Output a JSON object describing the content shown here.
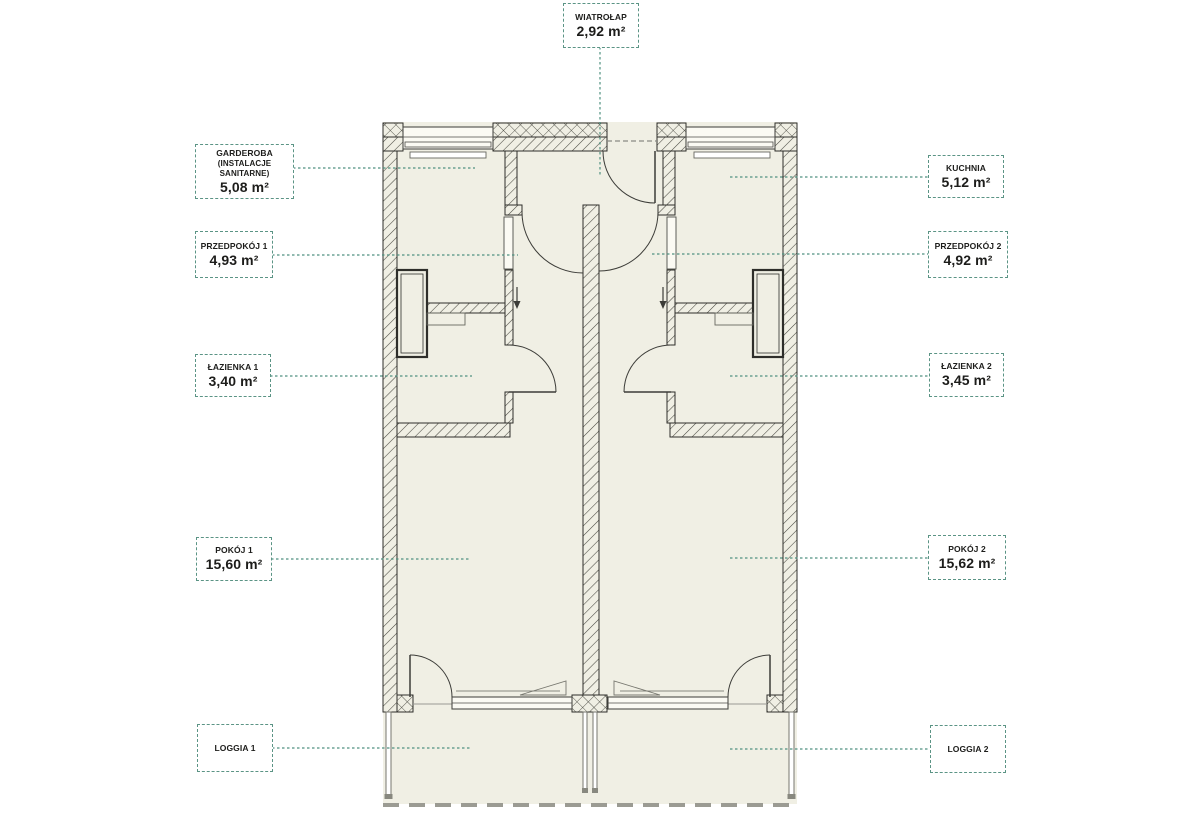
{
  "colors": {
    "accent_teal": "#4f9180",
    "floor_beige": "#f0efe4",
    "wall_line": "#2e2e2a",
    "label_border": "#5b9485"
  },
  "labels": {
    "wiatrolap": {
      "name": "WIATROŁAP",
      "area": "2,92 m²"
    },
    "garderoba": {
      "name": "GARDEROBA",
      "name2": "(INSTALACJE SANITARNE)",
      "area": "5,08 m²"
    },
    "przedpokoj1": {
      "name": "PRZEDPOKÓJ 1",
      "area": "4,93 m²"
    },
    "lazienka1": {
      "name": "ŁAZIENKA 1",
      "area": "3,40 m²"
    },
    "pokoj1": {
      "name": "POKÓJ 1",
      "area": "15,60 m²"
    },
    "loggia1": {
      "name": "LOGGIA 1"
    },
    "kuchnia": {
      "name": "KUCHNIA",
      "area": "5,12 m²"
    },
    "przedpokoj2": {
      "name": "PRZEDPOKÓJ 2",
      "area": "4,92 m²"
    },
    "lazienka2": {
      "name": "ŁAZIENKA 2",
      "area": "3,45 m²"
    },
    "pokoj2": {
      "name": "POKÓJ 2",
      "area": "15,62 m²"
    },
    "loggia2": {
      "name": "LOGGIA 2"
    }
  }
}
